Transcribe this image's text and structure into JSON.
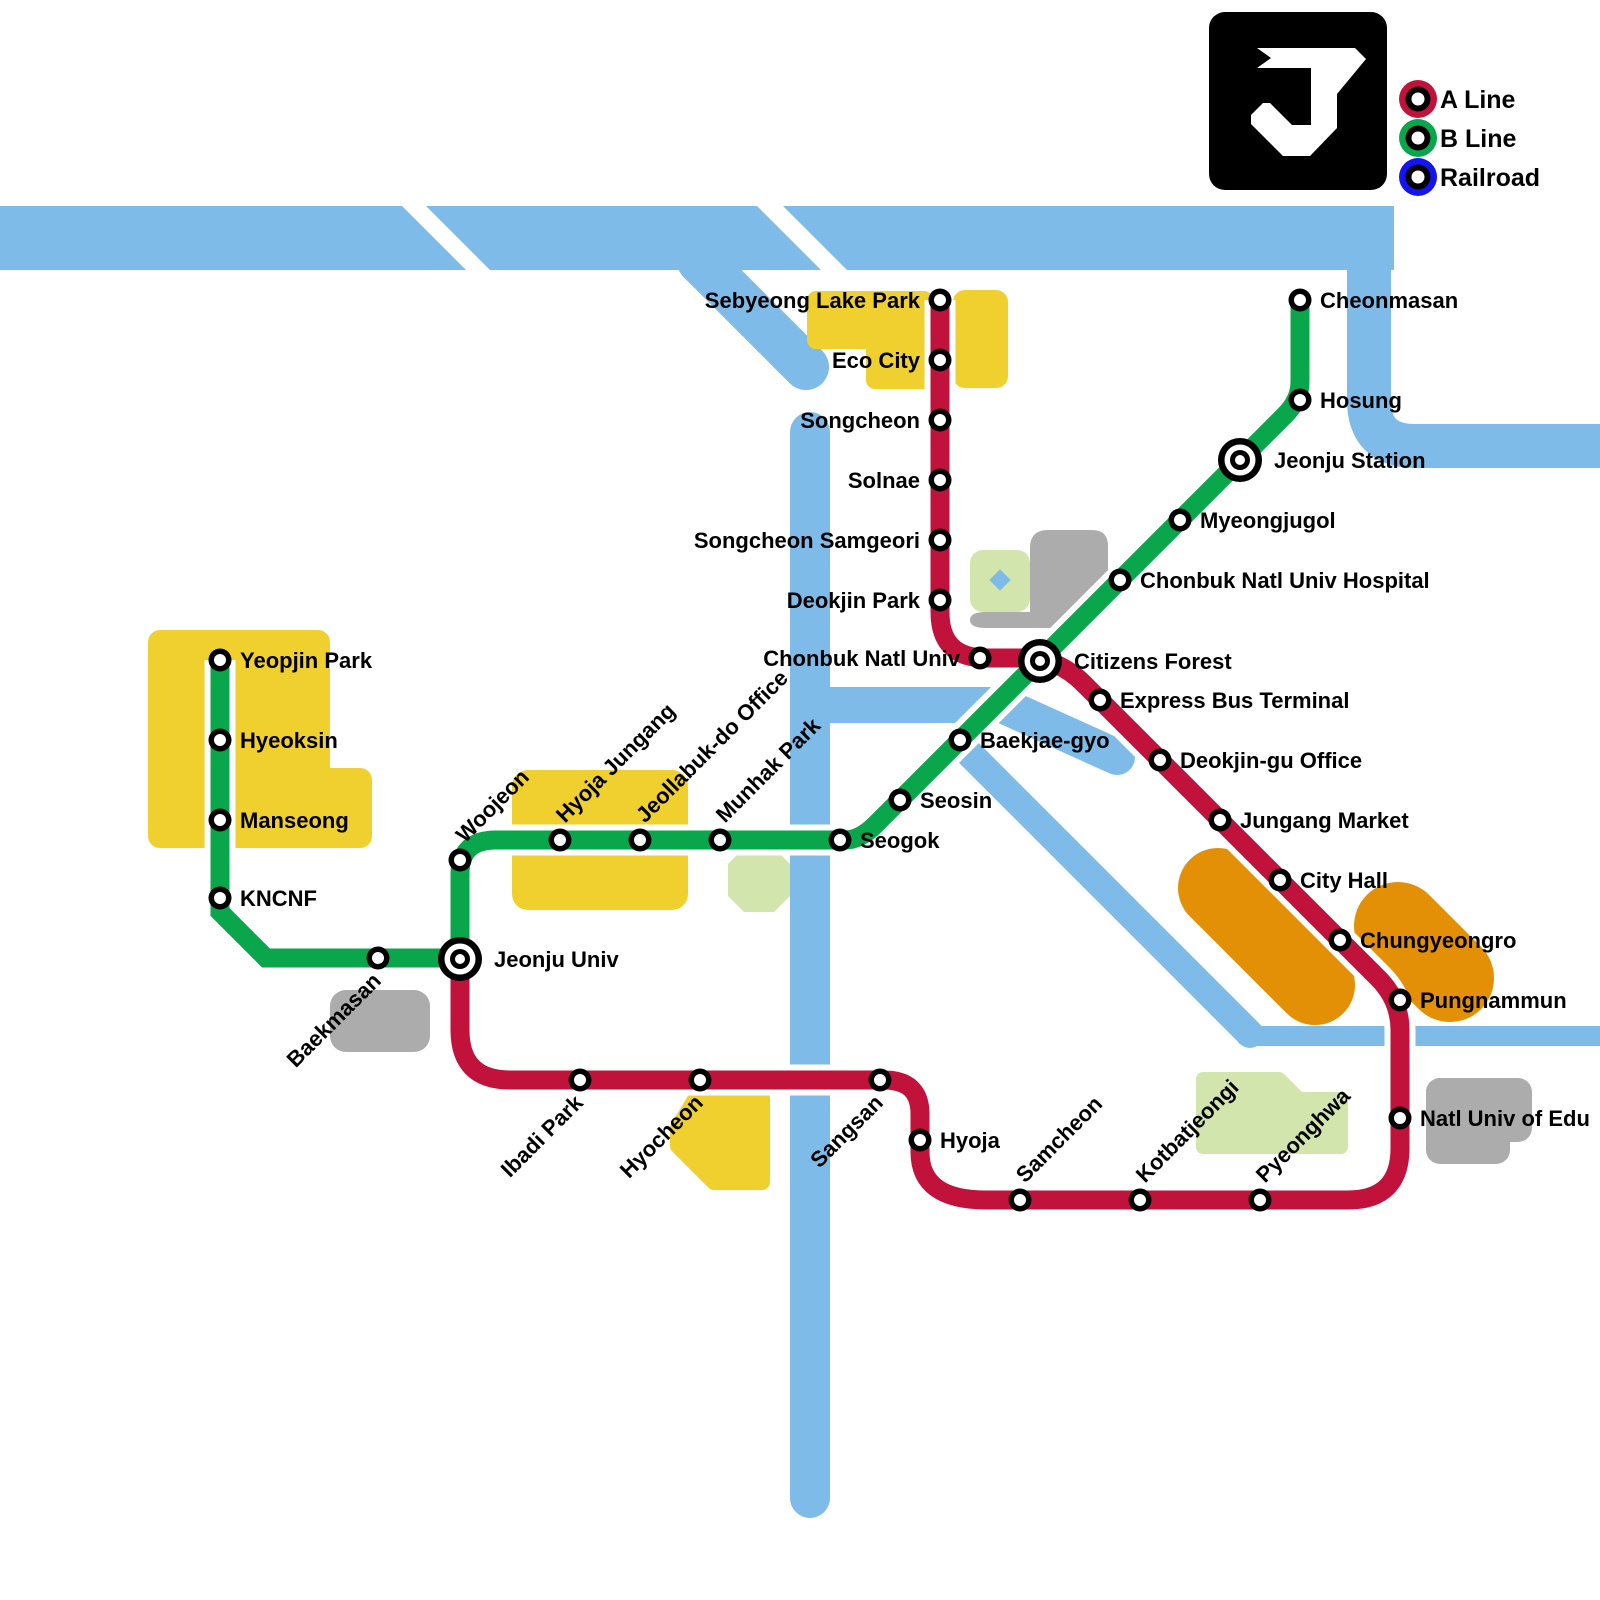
{
  "legend": {
    "logo_letter": "J",
    "items": [
      {
        "id": "a-line",
        "label": "A Line",
        "color": "#C1123C"
      },
      {
        "id": "b-line",
        "label": "B Line",
        "color": "#0AA64C"
      },
      {
        "id": "railroad",
        "label": "Railroad",
        "color": "#1414F0"
      }
    ]
  },
  "colors": {
    "a_line": "#C1123C",
    "b_line": "#0AA64C",
    "river": "#7EBBE8",
    "district_yellow": "#EFD02F",
    "district_orange": "#E39006",
    "district_green": "#D2E5AC",
    "district_gray": "#ACACAC",
    "station_ring": "#000000",
    "station_fill": "#ffffff"
  },
  "stations": [
    {
      "name": "Sebyeong Lake Park",
      "x": 940,
      "y": 300,
      "label": "left",
      "type": "regular",
      "lines": [
        "A"
      ]
    },
    {
      "name": "Eco City",
      "x": 940,
      "y": 360,
      "label": "left",
      "type": "regular",
      "lines": [
        "A"
      ]
    },
    {
      "name": "Songcheon",
      "x": 940,
      "y": 420,
      "label": "left",
      "type": "regular",
      "lines": [
        "A"
      ]
    },
    {
      "name": "Solnae",
      "x": 940,
      "y": 480,
      "label": "left",
      "type": "regular",
      "lines": [
        "A"
      ]
    },
    {
      "name": "Songcheon Samgeori",
      "x": 940,
      "y": 540,
      "label": "left",
      "type": "regular",
      "lines": [
        "A"
      ]
    },
    {
      "name": "Deokjin Park",
      "x": 940,
      "y": 600,
      "label": "left",
      "type": "regular",
      "lines": [
        "A"
      ]
    },
    {
      "name": "Chonbuk Natl Univ",
      "x": 980,
      "y": 658,
      "label": "left",
      "type": "regular",
      "lines": [
        "A"
      ]
    },
    {
      "name": "Citizens Forest",
      "x": 1040,
      "y": 661,
      "label": "right",
      "type": "interchange",
      "lines": [
        "A",
        "B"
      ]
    },
    {
      "name": "Express Bus Terminal",
      "x": 1100,
      "y": 700,
      "label": "right",
      "type": "regular",
      "lines": [
        "A"
      ]
    },
    {
      "name": "Deokjin-gu Office",
      "x": 1160,
      "y": 760,
      "label": "right",
      "type": "regular",
      "lines": [
        "A"
      ]
    },
    {
      "name": "Jungang Market",
      "x": 1220,
      "y": 820,
      "label": "right",
      "type": "regular",
      "lines": [
        "A"
      ]
    },
    {
      "name": "City Hall",
      "x": 1280,
      "y": 880,
      "label": "right",
      "type": "regular",
      "lines": [
        "A"
      ]
    },
    {
      "name": "Chungyeongro",
      "x": 1340,
      "y": 940,
      "label": "right",
      "type": "regular",
      "lines": [
        "A"
      ]
    },
    {
      "name": "Pungnammun",
      "x": 1400,
      "y": 1000,
      "label": "right",
      "type": "regular",
      "lines": [
        "A"
      ]
    },
    {
      "name": "Natl Univ of Edu",
      "x": 1400,
      "y": 1118,
      "label": "right",
      "type": "regular",
      "lines": [
        "A"
      ]
    },
    {
      "name": "Pyeonghwa",
      "x": 1260,
      "y": 1200,
      "label": "diag_up",
      "type": "regular",
      "lines": [
        "A"
      ]
    },
    {
      "name": "Kotbatjeongi",
      "x": 1140,
      "y": 1200,
      "label": "diag_up",
      "type": "regular",
      "lines": [
        "A"
      ]
    },
    {
      "name": "Samcheon",
      "x": 1020,
      "y": 1200,
      "label": "diag_up",
      "type": "regular",
      "lines": [
        "A"
      ]
    },
    {
      "name": "Hyoja",
      "x": 920,
      "y": 1140,
      "label": "right",
      "type": "regular",
      "lines": [
        "A"
      ]
    },
    {
      "name": "Sangsan",
      "x": 880,
      "y": 1080,
      "label": "diag_down",
      "type": "regular",
      "lines": [
        "A"
      ]
    },
    {
      "name": "Hyocheon",
      "x": 700,
      "y": 1080,
      "label": "diag_down",
      "type": "regular",
      "lines": [
        "A"
      ]
    },
    {
      "name": "Ibadi Park",
      "x": 580,
      "y": 1080,
      "label": "diag_down",
      "type": "regular",
      "lines": [
        "A"
      ]
    },
    {
      "name": "Jeonju Univ",
      "x": 460,
      "y": 959,
      "label": "right",
      "type": "interchange",
      "lines": [
        "A",
        "B"
      ]
    },
    {
      "name": "Yeopjin Park",
      "x": 220,
      "y": 660,
      "label": "right",
      "type": "regular",
      "lines": [
        "B"
      ]
    },
    {
      "name": "Hyeoksin",
      "x": 220,
      "y": 740,
      "label": "right",
      "type": "regular",
      "lines": [
        "B"
      ]
    },
    {
      "name": "Manseong",
      "x": 220,
      "y": 820,
      "label": "right",
      "type": "regular",
      "lines": [
        "B"
      ]
    },
    {
      "name": "KNCNF",
      "x": 220,
      "y": 898,
      "label": "right",
      "type": "regular",
      "lines": [
        "B"
      ]
    },
    {
      "name": "Baekmasan",
      "x": 378,
      "y": 958,
      "label": "diag_down",
      "type": "regular",
      "lines": [
        "B"
      ]
    },
    {
      "name": "Woojeon",
      "x": 460,
      "y": 860,
      "label": "diag_up",
      "type": "regular",
      "lines": [
        "B"
      ]
    },
    {
      "name": "Hyoja Jungang",
      "x": 560,
      "y": 840,
      "label": "diag_up",
      "type": "regular",
      "lines": [
        "B"
      ]
    },
    {
      "name": "Jeollabuk-do Office",
      "x": 640,
      "y": 840,
      "label": "diag_up",
      "type": "regular",
      "lines": [
        "B"
      ]
    },
    {
      "name": "Munhak Park",
      "x": 720,
      "y": 840,
      "label": "diag_up",
      "type": "regular",
      "lines": [
        "B"
      ]
    },
    {
      "name": "Seogok",
      "x": 840,
      "y": 840,
      "label": "right",
      "type": "regular",
      "lines": [
        "B"
      ]
    },
    {
      "name": "Seosin",
      "x": 900,
      "y": 800,
      "label": "right",
      "type": "regular",
      "lines": [
        "B"
      ]
    },
    {
      "name": "Baekjae-gyo",
      "x": 960,
      "y": 740,
      "label": "right",
      "type": "regular",
      "lines": [
        "B"
      ]
    },
    {
      "name": "Chonbuk Natl Univ Hospital",
      "x": 1120,
      "y": 580,
      "label": "right",
      "type": "regular",
      "lines": [
        "B"
      ]
    },
    {
      "name": "Myeongjugol",
      "x": 1180,
      "y": 520,
      "label": "right",
      "type": "regular",
      "lines": [
        "B"
      ]
    },
    {
      "name": "Jeonju Station",
      "x": 1240,
      "y": 460,
      "label": "right",
      "type": "interchange",
      "lines": [
        "B"
      ]
    },
    {
      "name": "Hosung",
      "x": 1300,
      "y": 400,
      "label": "right",
      "type": "regular",
      "lines": [
        "B"
      ]
    },
    {
      "name": "Cheonmasan",
      "x": 1300,
      "y": 300,
      "label": "right",
      "type": "regular",
      "lines": [
        "B"
      ]
    }
  ]
}
